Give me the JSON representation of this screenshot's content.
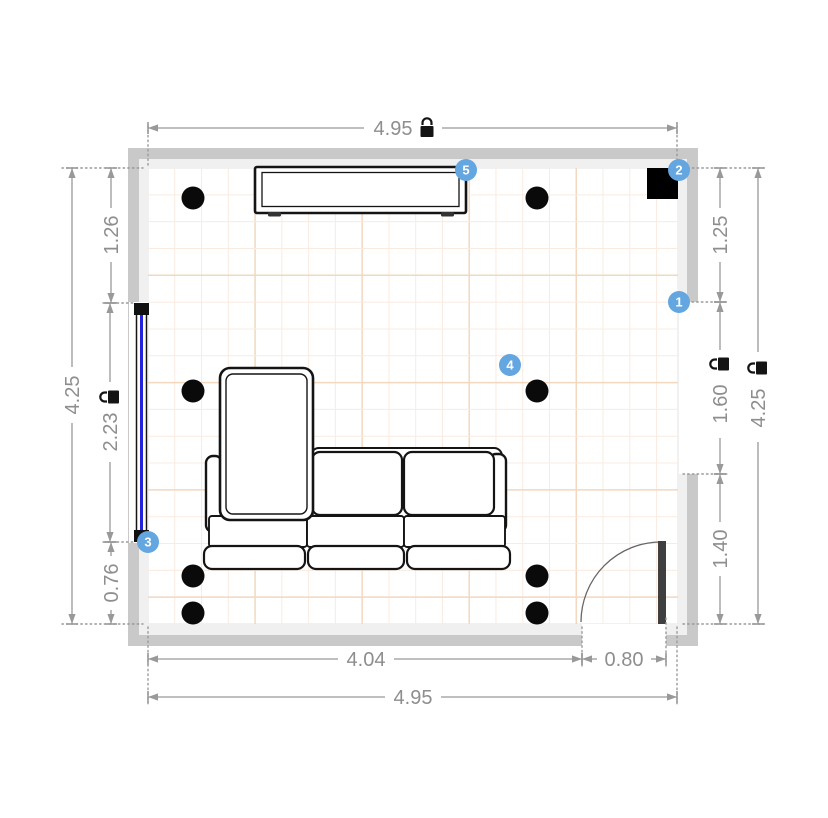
{
  "canvas": {
    "width": 828,
    "height": 818
  },
  "dims": {
    "top_width": {
      "value": "4.95",
      "locked": true
    },
    "left_height": {
      "value": "4.25",
      "locked": false
    },
    "left_upper": {
      "value": "1.26",
      "locked": false
    },
    "left_window": {
      "value": "2.23",
      "locked": true
    },
    "left_lower": {
      "value": "0.76",
      "locked": false
    },
    "right_height": {
      "value": "4.25",
      "locked": true
    },
    "right_upper": {
      "value": "1.25",
      "locked": false
    },
    "right_opening": {
      "value": "1.60",
      "locked": true
    },
    "right_lower": {
      "value": "1.40",
      "locked": false
    },
    "bottom_left_span": {
      "value": "4.04",
      "locked": false
    },
    "bottom_door": {
      "value": "0.80",
      "locked": false
    },
    "bottom_width": {
      "value": "4.95",
      "locked": false
    }
  },
  "badges": [
    {
      "label": "1"
    },
    {
      "label": "2"
    },
    {
      "label": "3"
    },
    {
      "label": "4"
    },
    {
      "label": "5"
    }
  ],
  "objects": [
    "sectional-sofa",
    "tv-sideboard",
    "window",
    "door",
    "corner-speaker-block",
    "dot-marker-x8"
  ],
  "colors": {
    "badge_blue": "#63a6e0",
    "window_blue": "#2323dd",
    "wall_outer": "#c9c9c9",
    "wall_inner": "#f0f0f0",
    "grid_minor": "#f9ebe0",
    "grid_major": "#f2d8bf",
    "dim_line": "#999999",
    "dim_text": "#8e8e8e",
    "door_leaf": "#3f3f3f",
    "dot_black": "#0a0a0a"
  }
}
